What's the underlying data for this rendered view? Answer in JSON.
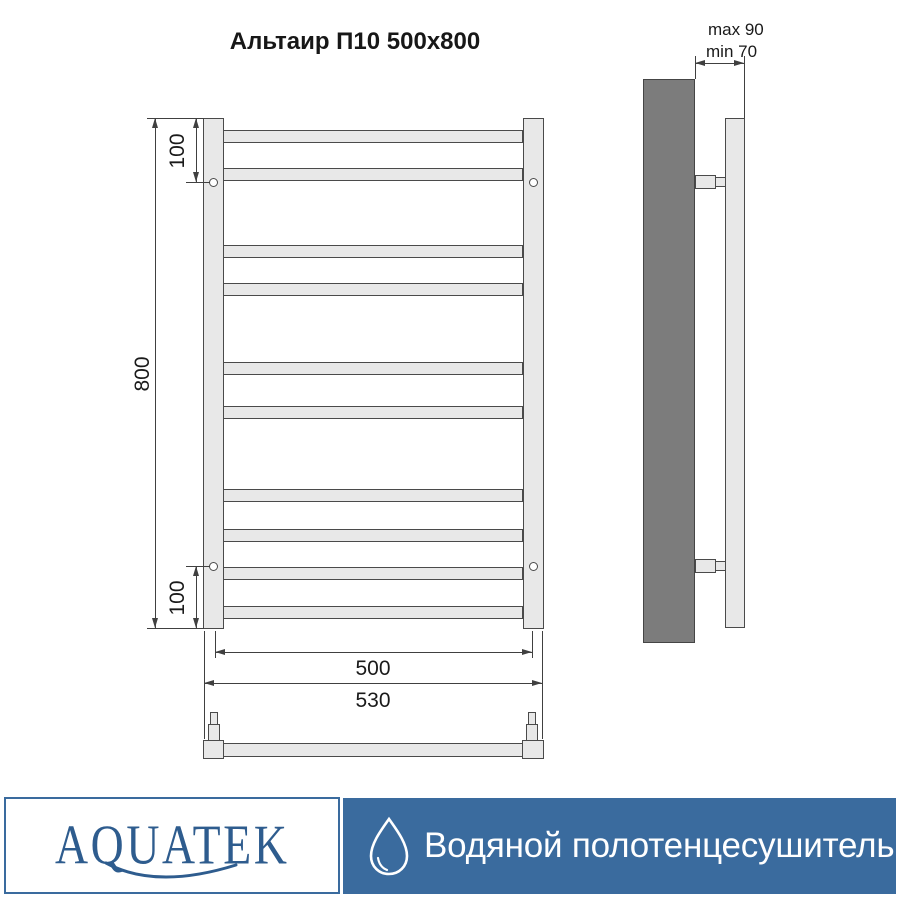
{
  "title": "Альтаир П10 500x800",
  "views": {
    "front": {
      "rung_count": 10,
      "rung_tops_px": [
        130,
        168,
        245,
        283,
        362,
        406,
        489,
        529,
        567,
        606
      ],
      "dimensions": {
        "height": "800",
        "top_bracket_offset": "100",
        "bottom_bracket_offset": "100",
        "axis_width": "500",
        "overall_width": "530"
      }
    },
    "side": {
      "dimensions": {
        "wall_distance_max": "max 90",
        "wall_distance_min": "min 70"
      }
    }
  },
  "footer": {
    "brand": "AQUATEK",
    "product_type": "Водяной полотенцесушитель",
    "colors": {
      "banner": "#3a6b9e",
      "brand_text": "#2e5c8e"
    },
    "icons": {
      "drop": "water-drop-icon"
    }
  },
  "colors": {
    "line": "#404040",
    "outline": "#4a4a4a",
    "metal_fill": "#e8e8e8",
    "wall_fill": "#7c7c7c",
    "background": "#ffffff"
  }
}
